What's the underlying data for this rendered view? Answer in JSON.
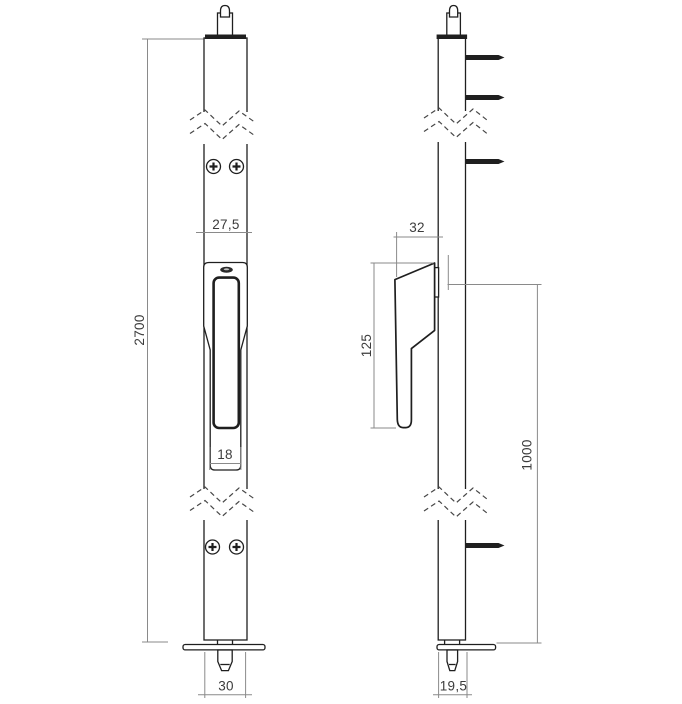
{
  "colors": {
    "background": "#ffffff",
    "outline": "#1f1f1f",
    "dimension": "#8a8a8a",
    "label": "#3c3c3c"
  },
  "views": {
    "front": {
      "dims": {
        "plate_width": "27,5",
        "overall_height": "2700",
        "handle_width": "18",
        "base_plate_width": "30"
      }
    },
    "side": {
      "dims": {
        "handle_depth": "32",
        "handle_length": "125",
        "lower_section_height": "1000",
        "base_plate_depth": "19,5"
      }
    }
  }
}
